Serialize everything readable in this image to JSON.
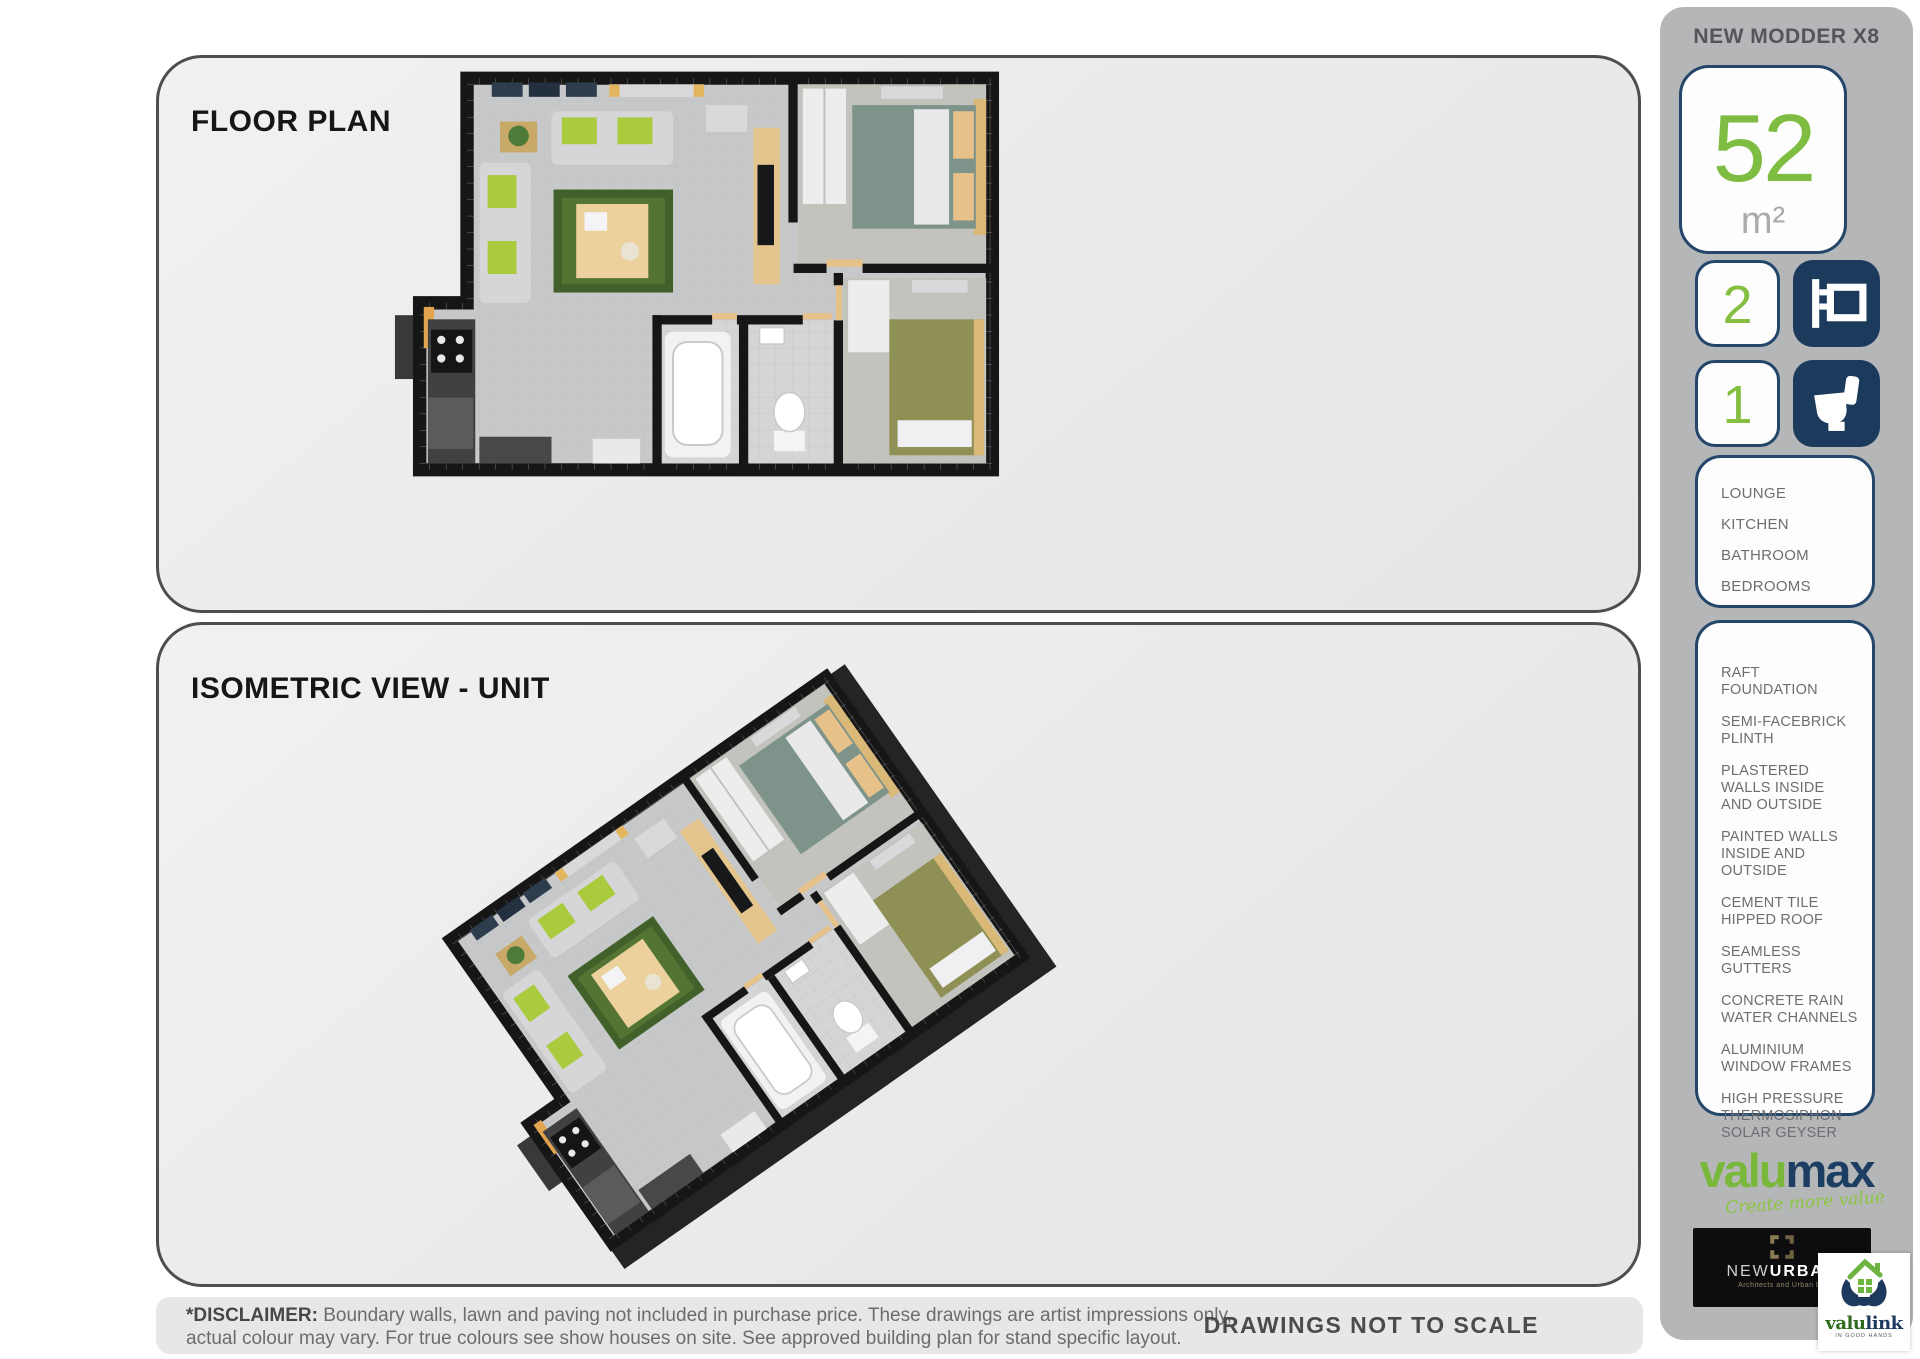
{
  "panels": {
    "floor_plan_title": "FLOOR PLAN",
    "isometric_title": "ISOMETRIC VIEW - UNIT"
  },
  "footer": {
    "disclaimer_label": "*DISCLAIMER:",
    "disclaimer_line1": " Boundary walls, lawn and paving not included in purchase price. These drawings are artist impressions only,",
    "disclaimer_line2": "actual colour may vary. For true colours see show houses on site. See approved building plan for stand specific layout.",
    "scale_note": "DRAWINGS NOT TO SCALE"
  },
  "sidebar": {
    "model_name": "NEW MODDER X8",
    "area": {
      "value": "52",
      "unit": "m²"
    },
    "bedrooms_count": "2",
    "bathrooms_count": "1",
    "icons": {
      "bedrooms": "bed-icon",
      "bathrooms": "toilet-icon"
    },
    "rooms": [
      "LOUNGE",
      "KITCHEN",
      "BATHROOM",
      "BEDROOMS"
    ],
    "features": [
      "RAFT FOUNDATION",
      "SEMI-FACEBRICK PLINTH",
      "PLASTERED WALLS INSIDE AND OUTSIDE",
      "PAINTED WALLS INSIDE AND OUTSIDE",
      "CEMENT TILE HIPPED ROOF",
      "SEAMLESS GUTTERS",
      "CONCRETE RAIN WATER CHANNELS",
      "ALUMINIUM WINDOW FRAMES",
      "HIGH PRESSURE THERMOSIPHON SOLAR GEYSER"
    ],
    "valumax": {
      "part1": "valu",
      "part2": "max",
      "tagline": "Create more value"
    },
    "newurban": {
      "part1": "NEW",
      "part2": "URBAN",
      "subtitle": "Architects and Urban De"
    },
    "valulink": {
      "part1": "valu",
      "part2": "link",
      "tagline": "IN GOOD HANDS"
    }
  },
  "colors": {
    "accent_green": "#7fbc42",
    "accent_navy": "#1b3a5c",
    "sidebar_gray": "#b5b6b8",
    "wall_black": "#161617"
  }
}
